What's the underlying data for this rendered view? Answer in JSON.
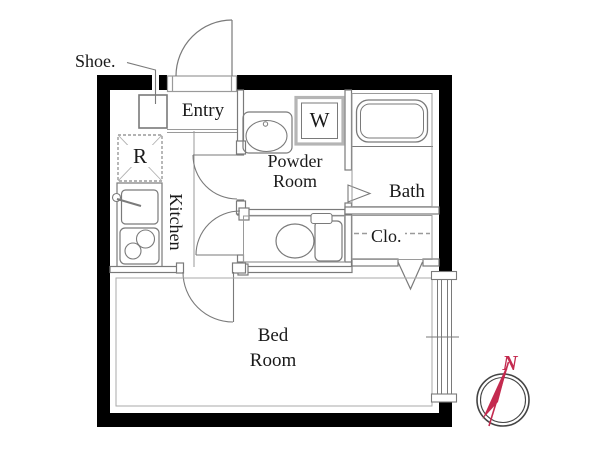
{
  "plan": {
    "labels": {
      "shoe": "Shoe.",
      "entry": "Entry",
      "refrigerator": "R",
      "kitchen": "Kitchen",
      "washer": "W",
      "powder_room_line1": "Powder",
      "powder_room_line2": "Room",
      "bath": "Bath",
      "closet": "Clo.",
      "bed_room_line1": "Bed",
      "bed_room_line2": "Room"
    },
    "compass": {
      "north": "N"
    },
    "colors": {
      "wall": "#000000",
      "thin_line": "#7a7a7a",
      "fixture_line": "#9a9a9a",
      "text": "#1a1a1a",
      "compass_red": "#c42a4f",
      "background": "#ffffff"
    }
  }
}
